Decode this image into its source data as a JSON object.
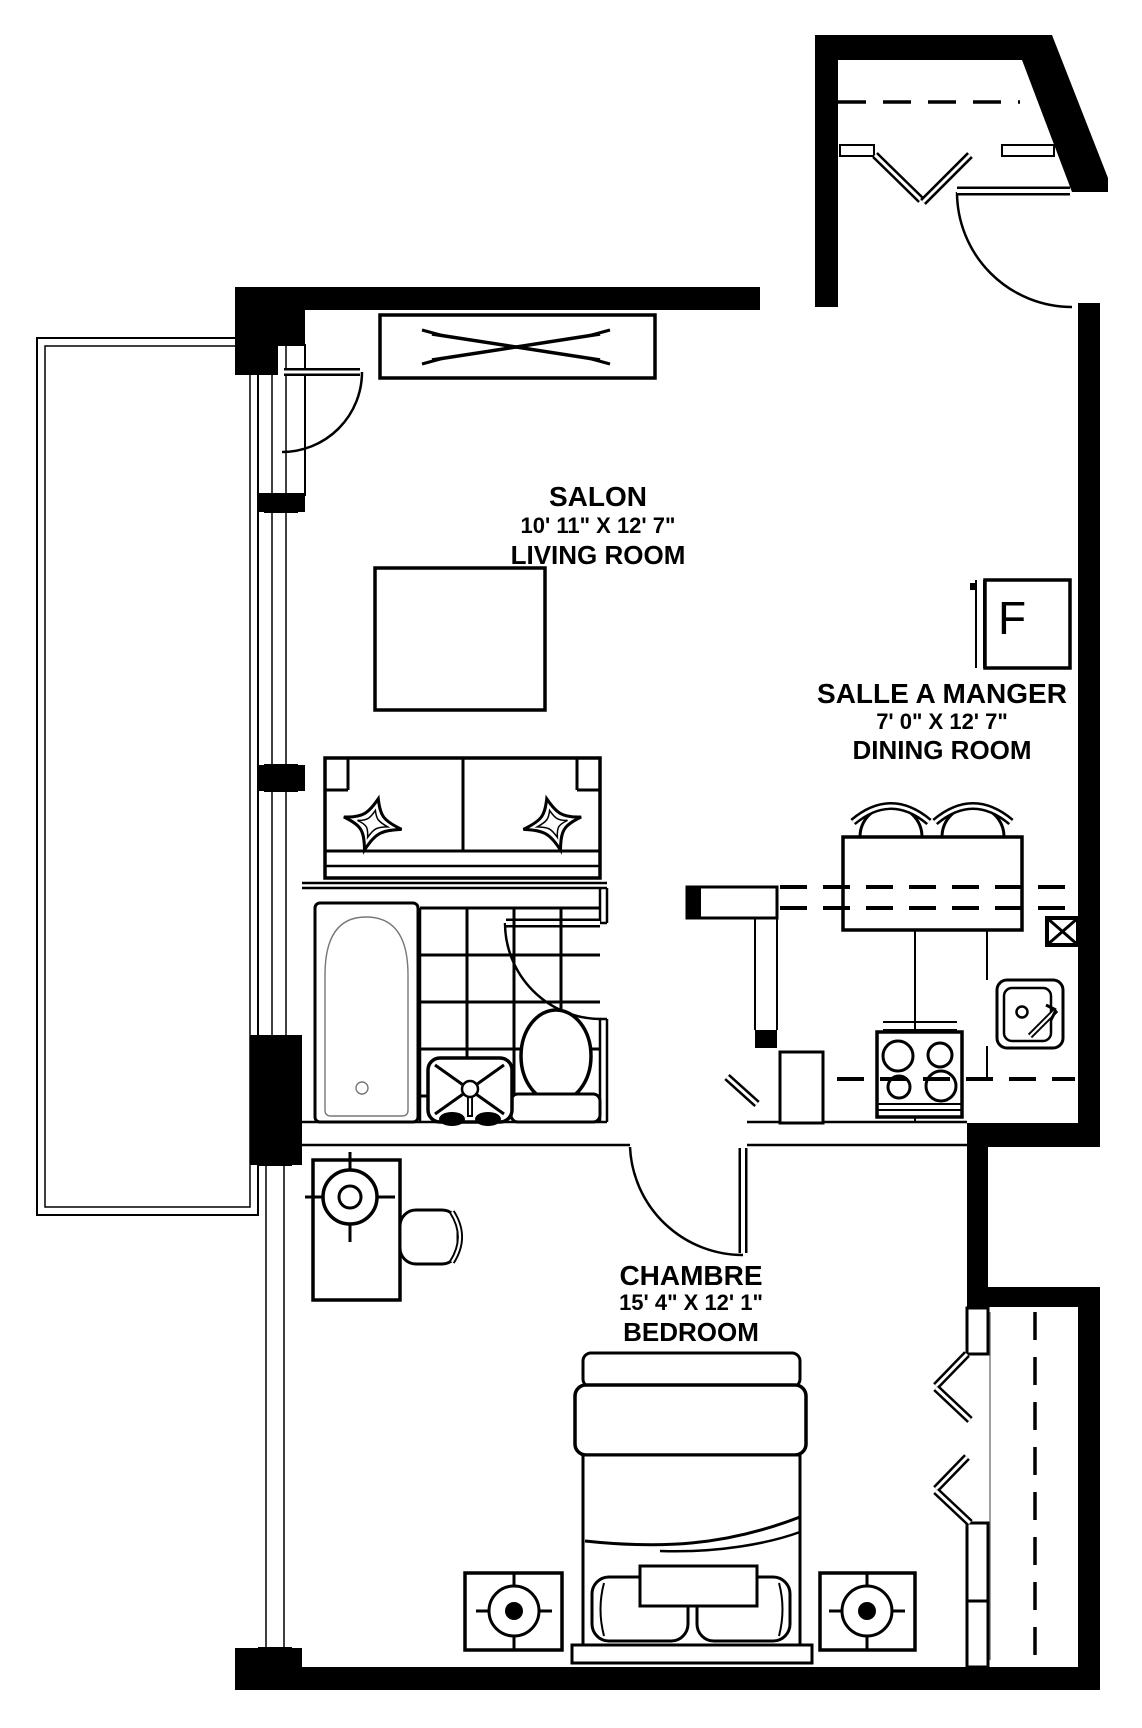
{
  "colors": {
    "walls": "#000000",
    "background": "#ffffff"
  },
  "rooms": [
    {
      "id": "living-room",
      "name_fr": "SALON",
      "dimensions": "10' 11\" X 12' 7\"",
      "name_en": "LIVING ROOM"
    },
    {
      "id": "dining-room",
      "name_fr": "SALLE A MANGER",
      "dimensions": "7' 0\" X 12' 7\"",
      "name_en": "DINING ROOM"
    },
    {
      "id": "bedroom",
      "name_fr": "CHAMBRE",
      "dimensions": "15' 4\" X 12' 1\"",
      "name_en": "BEDROOM"
    }
  ],
  "fridge_label": "F"
}
